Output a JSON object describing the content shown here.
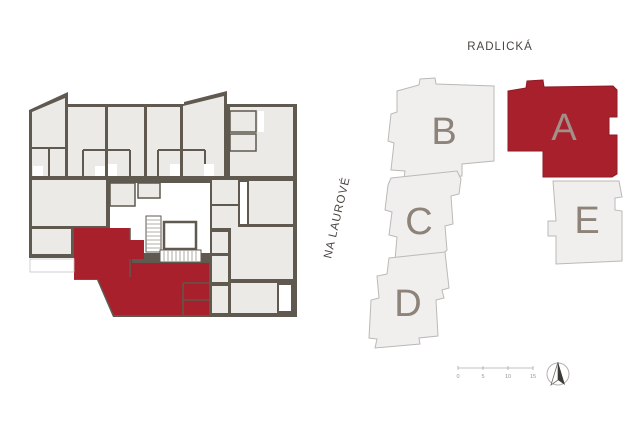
{
  "floor_plan": {
    "title": "floor-plan-detail",
    "highlight_color": "#a8202b",
    "wall_color": "#5f594f",
    "room_color": "#eceae7"
  },
  "site_plan": {
    "street_top": {
      "label": "RADLICKÁ"
    },
    "street_left": {
      "label": "NA LAUROVÉ"
    },
    "buildings": [
      {
        "id": "A",
        "label": "A",
        "highlighted": true
      },
      {
        "id": "B",
        "label": "B",
        "highlighted": false
      },
      {
        "id": "C",
        "label": "C",
        "highlighted": false
      },
      {
        "id": "D",
        "label": "D",
        "highlighted": false
      },
      {
        "id": "E",
        "label": "E",
        "highlighted": false
      }
    ],
    "scale_bar": {
      "ticks": [
        "0",
        "5",
        "10",
        "15"
      ]
    },
    "colors": {
      "highlight": "#a8202b",
      "highlight_stroke": "#8e1b24",
      "building_fill": "#f0efee",
      "building_stroke": "#bcb9b5",
      "letter": "#8d8379"
    }
  }
}
